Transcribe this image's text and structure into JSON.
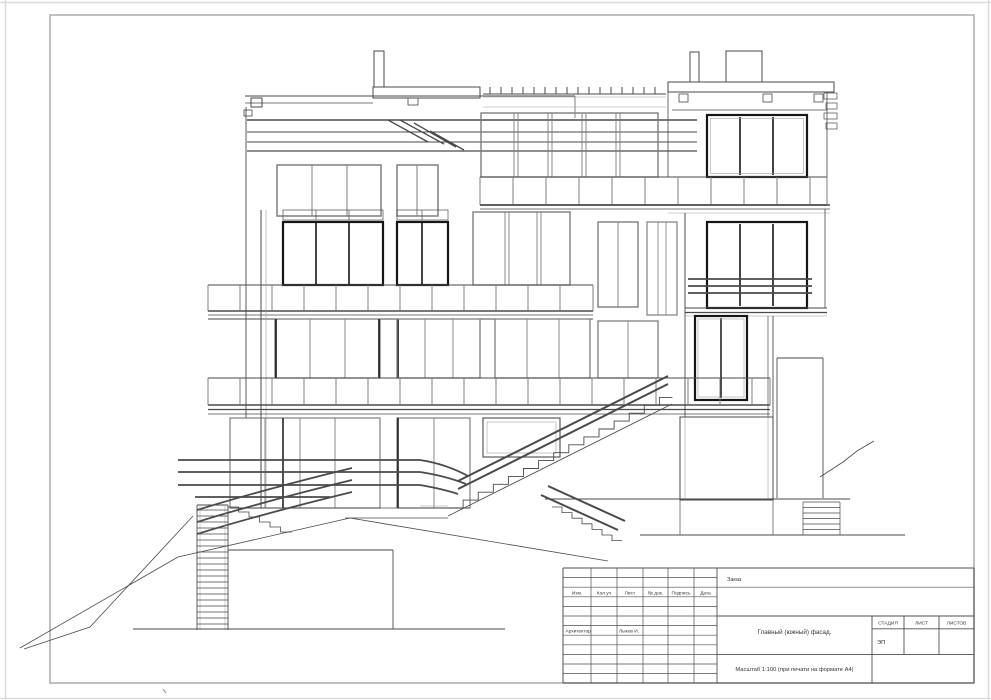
{
  "page": {
    "background": "#ffffff",
    "frame_color": "#b0b0b0",
    "line_color": "#4a4a4a",
    "dark_line_color": "#161616"
  },
  "title_block": {
    "order_label": "Заказ",
    "revision_columns": [
      "Изм.",
      "Кол.уч",
      "Лист",
      "№ док.",
      "Подпись",
      "Дата"
    ],
    "role_label": "Архитектор",
    "role_name": "Лыков И.",
    "drawing_title": "Главный (южный) фасад.",
    "stage_label": "СТАДИЯ",
    "sheet_label": "ЛИСТ",
    "sheets_label": "ЛИСТОВ",
    "stage_value": "ЭП",
    "scale_note": "Масштаб  1:100  (при печати на формате А4)"
  }
}
